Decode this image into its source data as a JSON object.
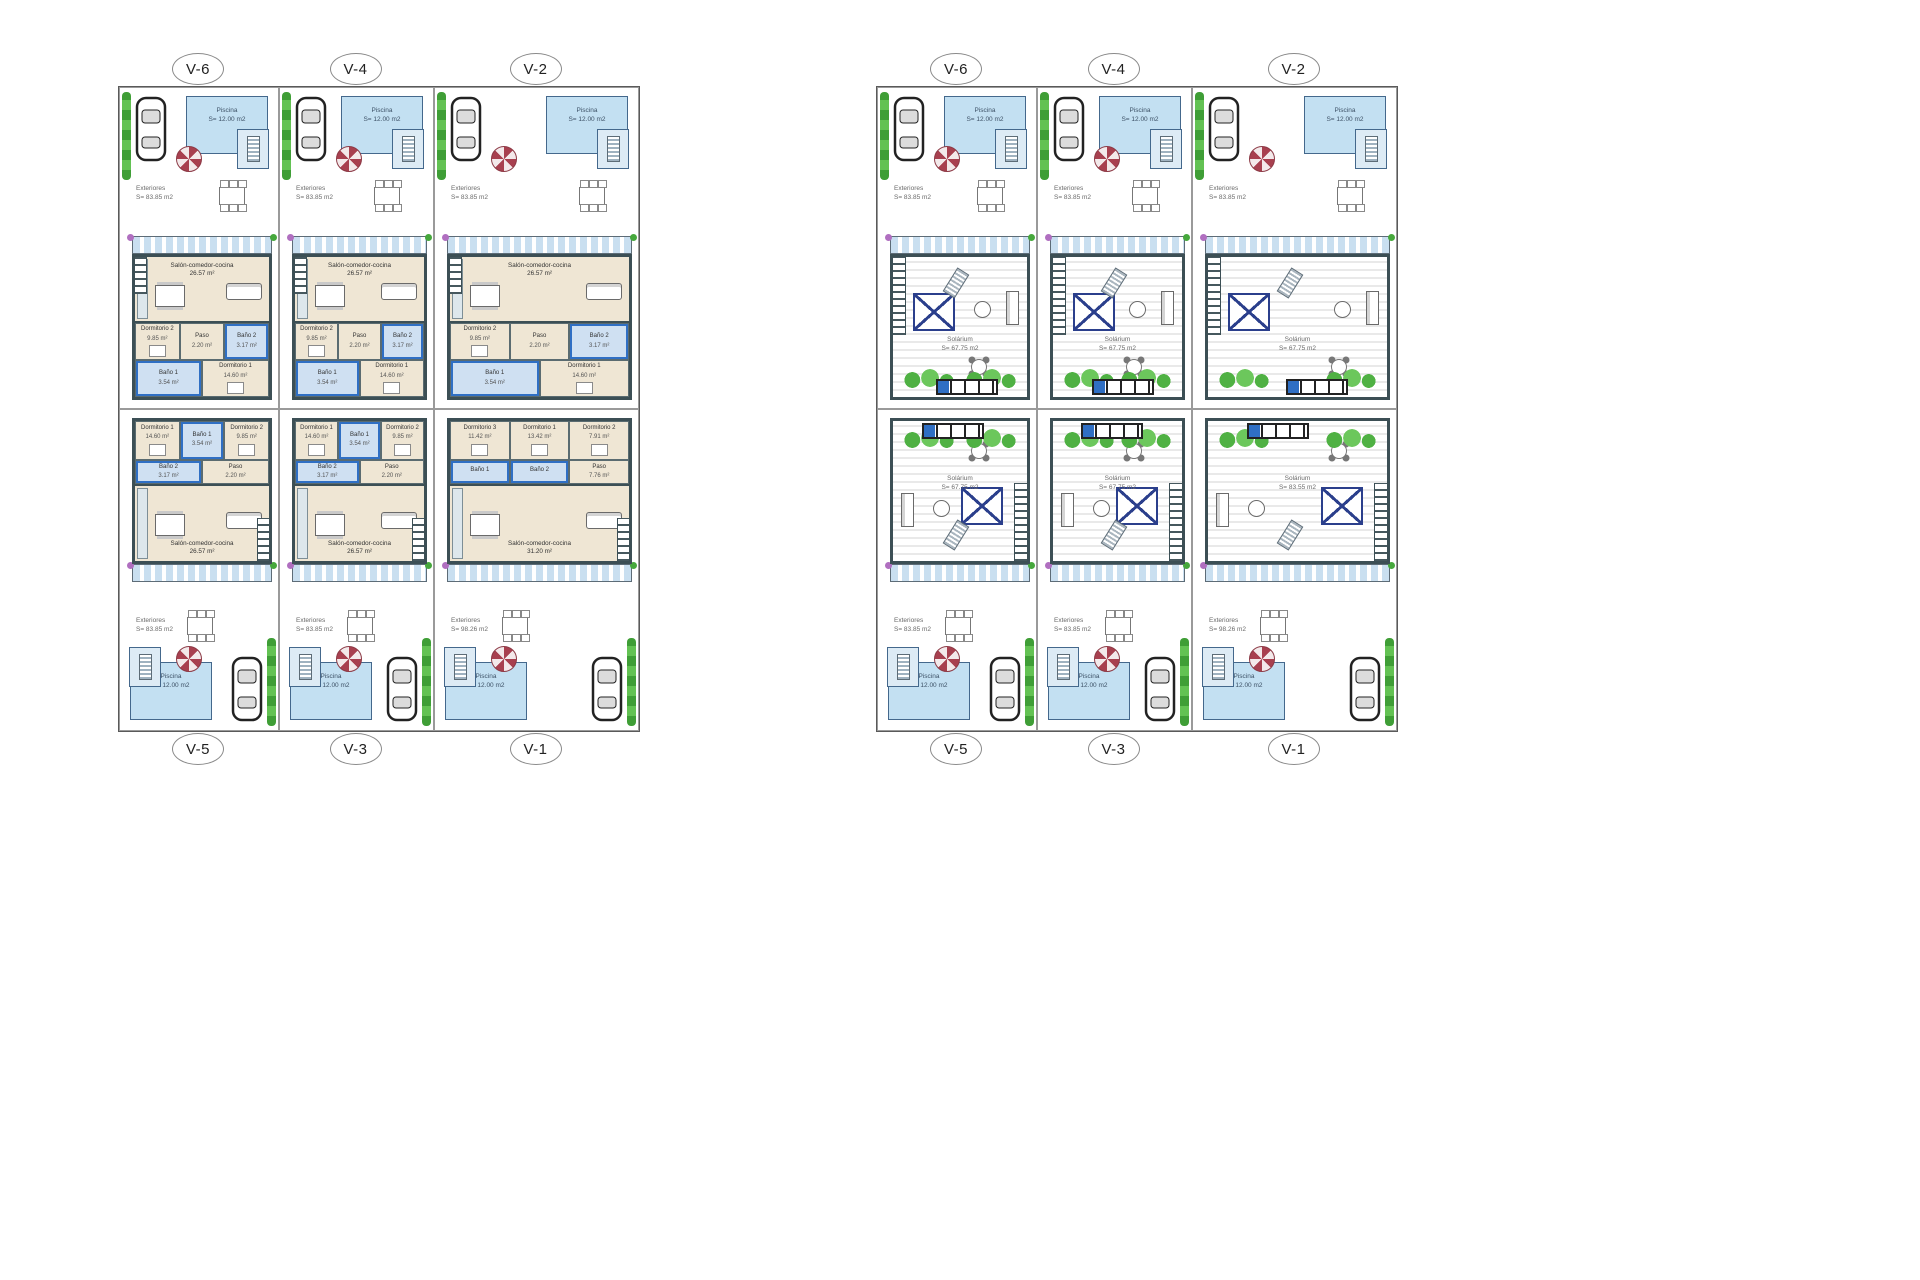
{
  "colors": {
    "wall": "#3c4f55",
    "pool_water": "#c3e0f2",
    "pergola_blue": "#c9dff0",
    "interior_floor": "#efe6d4",
    "wet_room_accent": "#2f6fc4",
    "skylight_frame": "#2b3f8c",
    "plant_green": "#4fb143",
    "hedge_green": "#3f9e36",
    "parasol_red": "#a8404f",
    "flower_purple": "#b06fc0"
  },
  "panels": [
    {
      "id": "ground-floor",
      "top_labels": [
        "V-6",
        "V-4",
        "V-2"
      ],
      "bottom_labels": [
        "V-5",
        "V-3",
        "V-1"
      ],
      "units": [
        {
          "id": "V-6",
          "row": "top",
          "variant": "standard",
          "pool": {
            "label": "Piscina",
            "area": "S= 12.00 m2"
          },
          "exterior": {
            "label": "Exteriores",
            "area": "S= 83.85 m2"
          },
          "salon": {
            "label": "Salón-comedor-cocina",
            "area": "26.57 m²"
          },
          "rooms": [
            {
              "label": "Dormitorio 2",
              "area": "9.85 m²",
              "type": "bedroom"
            },
            {
              "label": "Paso",
              "area": "2.20 m²",
              "type": "hall"
            },
            {
              "label": "Baño 2",
              "area": "3.17 m²",
              "type": "bath"
            },
            {
              "label": "Baño 1",
              "area": "3.54 m²",
              "type": "bath"
            },
            {
              "label": "Dormitorio 1",
              "area": "14.60 m²",
              "type": "bedroom"
            }
          ]
        },
        {
          "id": "V-4",
          "row": "top",
          "variant": "standard",
          "pool": {
            "label": "Piscina",
            "area": "S= 12.00 m2"
          },
          "exterior": {
            "label": "Exteriores",
            "area": "S= 83.85 m2"
          },
          "salon": {
            "label": "Salón-comedor-cocina",
            "area": "26.57 m²"
          },
          "rooms": [
            {
              "label": "Dormitorio 2",
              "area": "9.85 m²",
              "type": "bedroom"
            },
            {
              "label": "Paso",
              "area": "2.20 m²",
              "type": "hall"
            },
            {
              "label": "Baño 2",
              "area": "3.17 m²",
              "type": "bath"
            },
            {
              "label": "Baño 1",
              "area": "3.54 m²",
              "type": "bath"
            },
            {
              "label": "Dormitorio 1",
              "area": "14.60 m²",
              "type": "bedroom"
            }
          ]
        },
        {
          "id": "V-2",
          "row": "top",
          "variant": "standard",
          "pool": {
            "label": "Piscina",
            "area": "S= 12.00 m2"
          },
          "exterior": {
            "label": "Exteriores",
            "area": "S= 83.85 m2"
          },
          "salon": {
            "label": "Salón-comedor-cocina",
            "area": "26.57 m²"
          },
          "rooms": [
            {
              "label": "Dormitorio 2",
              "area": "9.85 m²",
              "type": "bedroom"
            },
            {
              "label": "Paso",
              "area": "2.20 m²",
              "type": "hall"
            },
            {
              "label": "Baño 2",
              "area": "3.17 m²",
              "type": "bath"
            },
            {
              "label": "Baño 1",
              "area": "3.54 m²",
              "type": "bath"
            },
            {
              "label": "Dormitorio 1",
              "area": "14.60 m²",
              "type": "bedroom"
            }
          ]
        },
        {
          "id": "V-5",
          "row": "bottom",
          "variant": "standard",
          "pool": {
            "label": "Piscina",
            "area": "S= 12.00 m2"
          },
          "exterior": {
            "label": "Exteriores",
            "area": "S= 83.85 m2"
          },
          "salon": {
            "label": "Salón-comedor-cocina",
            "area": "26.57 m²"
          },
          "rooms": [
            {
              "label": "Dormitorio 1",
              "area": "14.60 m²",
              "type": "bedroom"
            },
            {
              "label": "Baño 1",
              "area": "3.54 m²",
              "type": "bath"
            },
            {
              "label": "Dormitorio 2",
              "area": "9.85 m²",
              "type": "bedroom"
            },
            {
              "label": "Baño 2",
              "area": "3.17 m²",
              "type": "bath"
            },
            {
              "label": "Paso",
              "area": "2.20 m²",
              "type": "hall"
            }
          ]
        },
        {
          "id": "V-3",
          "row": "bottom",
          "variant": "standard",
          "pool": {
            "label": "Piscina",
            "area": "S= 12.00 m2"
          },
          "exterior": {
            "label": "Exteriores",
            "area": "S= 83.85 m2"
          },
          "salon": {
            "label": "Salón-comedor-cocina",
            "area": "26.57 m²"
          },
          "rooms": [
            {
              "label": "Dormitorio 1",
              "area": "14.60 m²",
              "type": "bedroom"
            },
            {
              "label": "Baño 1",
              "area": "3.54 m²",
              "type": "bath"
            },
            {
              "label": "Dormitorio 2",
              "area": "9.85 m²",
              "type": "bedroom"
            },
            {
              "label": "Baño 2",
              "area": "3.17 m²",
              "type": "bath"
            },
            {
              "label": "Paso",
              "area": "2.20 m²",
              "type": "hall"
            }
          ]
        },
        {
          "id": "V-1",
          "row": "bottom",
          "variant": "v1",
          "pool": {
            "label": "Piscina",
            "area": "S= 12.00 m2"
          },
          "exterior": {
            "label": "Exteriores",
            "area": "S= 98.26 m2"
          },
          "salon": {
            "label": "Salón-comedor-cocina",
            "area": "31.20 m²"
          },
          "rooms": [
            {
              "label": "Dormitorio 3",
              "area": "11.42 m²",
              "type": "bedroom"
            },
            {
              "label": "Dormitorio 1",
              "area": "13.42 m²",
              "type": "bedroom"
            },
            {
              "label": "Dormitorio 2",
              "area": "7.91 m²",
              "type": "bedroom"
            },
            {
              "label": "Baño 1",
              "area": "",
              "type": "bath"
            },
            {
              "label": "Baño 2",
              "area": "",
              "type": "bath"
            },
            {
              "label": "Paso",
              "area": "7.76 m²",
              "type": "hall"
            }
          ]
        }
      ]
    },
    {
      "id": "solarium-floor",
      "top_labels": [
        "V-6",
        "V-4",
        "V-2"
      ],
      "bottom_labels": [
        "V-5",
        "V-3",
        "V-1"
      ],
      "units": [
        {
          "id": "V-6",
          "row": "top",
          "variant": "standard",
          "pool": {
            "label": "Piscina",
            "area": "S= 12.00 m2"
          },
          "exterior": {
            "label": "Exteriores",
            "area": "S= 83.85 m2"
          },
          "solarium": {
            "label": "Solárium",
            "area": "S= 67.75 m2"
          }
        },
        {
          "id": "V-4",
          "row": "top",
          "variant": "standard",
          "pool": {
            "label": "Piscina",
            "area": "S= 12.00 m2"
          },
          "exterior": {
            "label": "Exteriores",
            "area": "S= 83.85 m2"
          },
          "solarium": {
            "label": "Solárium",
            "area": "S= 67.75 m2"
          }
        },
        {
          "id": "V-2",
          "row": "top",
          "variant": "standard",
          "pool": {
            "label": "Piscina",
            "area": "S= 12.00 m2"
          },
          "exterior": {
            "label": "Exteriores",
            "area": "S= 83.85 m2"
          },
          "solarium": {
            "label": "Solárium",
            "area": "S= 67.75 m2"
          }
        },
        {
          "id": "V-5",
          "row": "bottom",
          "variant": "standard",
          "pool": {
            "label": "Piscina",
            "area": "S= 12.00 m2"
          },
          "exterior": {
            "label": "Exteriores",
            "area": "S= 83.85 m2"
          },
          "solarium": {
            "label": "Solárium",
            "area": "S= 67.75 m2"
          }
        },
        {
          "id": "V-3",
          "row": "bottom",
          "variant": "standard",
          "pool": {
            "label": "Piscina",
            "area": "S= 12.00 m2"
          },
          "exterior": {
            "label": "Exteriores",
            "area": "S= 83.85 m2"
          },
          "solarium": {
            "label": "Solárium",
            "area": "S= 67.75 m2"
          }
        },
        {
          "id": "V-1",
          "row": "bottom",
          "variant": "v1",
          "pool": {
            "label": "Piscina",
            "area": "S= 12.00 m2"
          },
          "exterior": {
            "label": "Exteriores",
            "area": "S= 98.26 m2"
          },
          "solarium": {
            "label": "Solárium",
            "area": "S= 83.55 m2"
          }
        }
      ]
    }
  ]
}
